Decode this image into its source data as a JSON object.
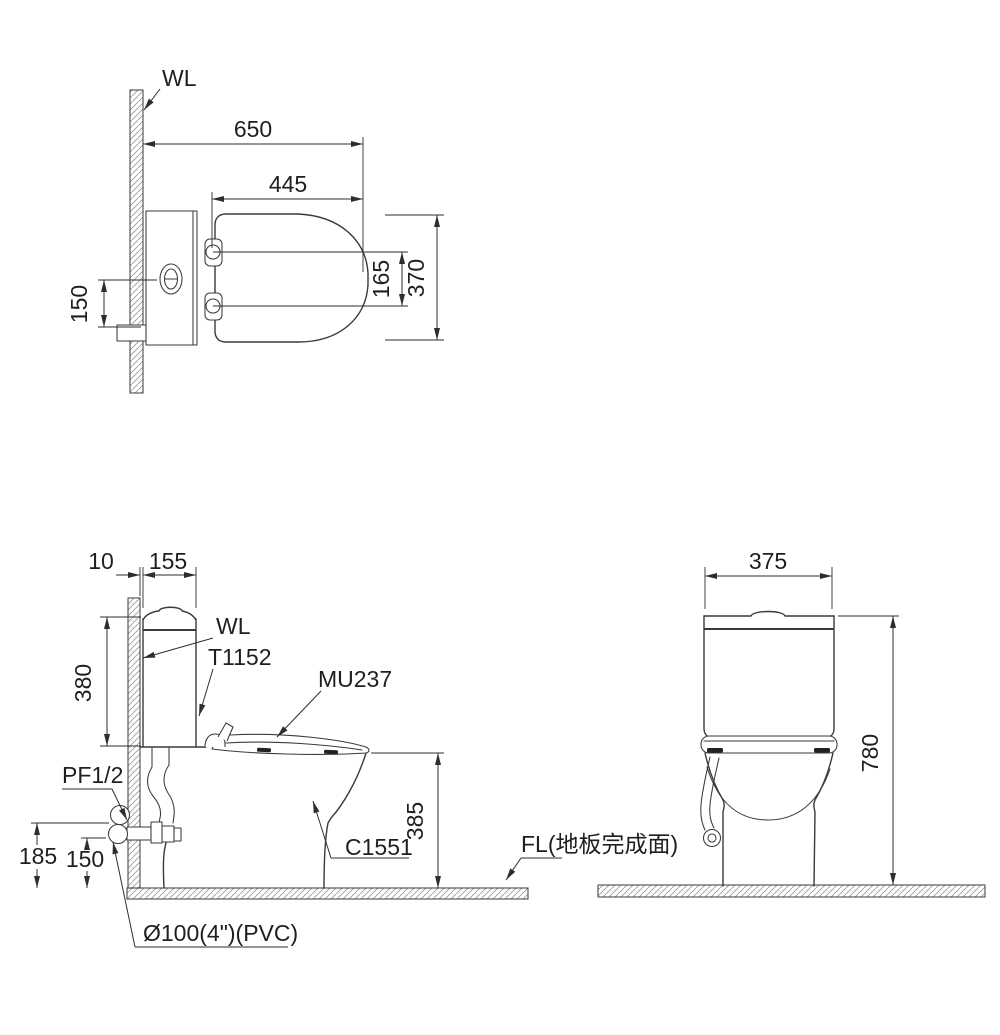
{
  "title": "Toilet suite installation technical drawing",
  "colors": {
    "background": "#ffffff",
    "line": "#3a3a3a",
    "dimension": "#2e2e2e",
    "hatch": "#9b9b9b",
    "bumper": "#222222"
  },
  "plan_view": {
    "wall_label": "WL",
    "dim_total_depth_from_wall": "650",
    "dim_seat_length": "445",
    "dim_hinge_hole_spacing": "165",
    "dim_seat_width": "370",
    "dim_supply_offset": "150"
  },
  "side_view": {
    "wall_label": "WL",
    "dim_wall_to_tank_gap": "10",
    "dim_tank_depth": "155",
    "dim_tank_height": "380",
    "dim_supply_height": "185",
    "dim_drain_height": "150",
    "dim_rim_height": "385",
    "tank_model": "T1152",
    "seat_model": "MU237",
    "bowl_model": "C1551",
    "supply_fitting_label": "PF1/2",
    "drain_pipe_label": "Ø100(4\")(PVC)",
    "floor_level_label": "FL(地板完成面)"
  },
  "front_view": {
    "dim_tank_width": "375",
    "dim_total_height": "780"
  }
}
